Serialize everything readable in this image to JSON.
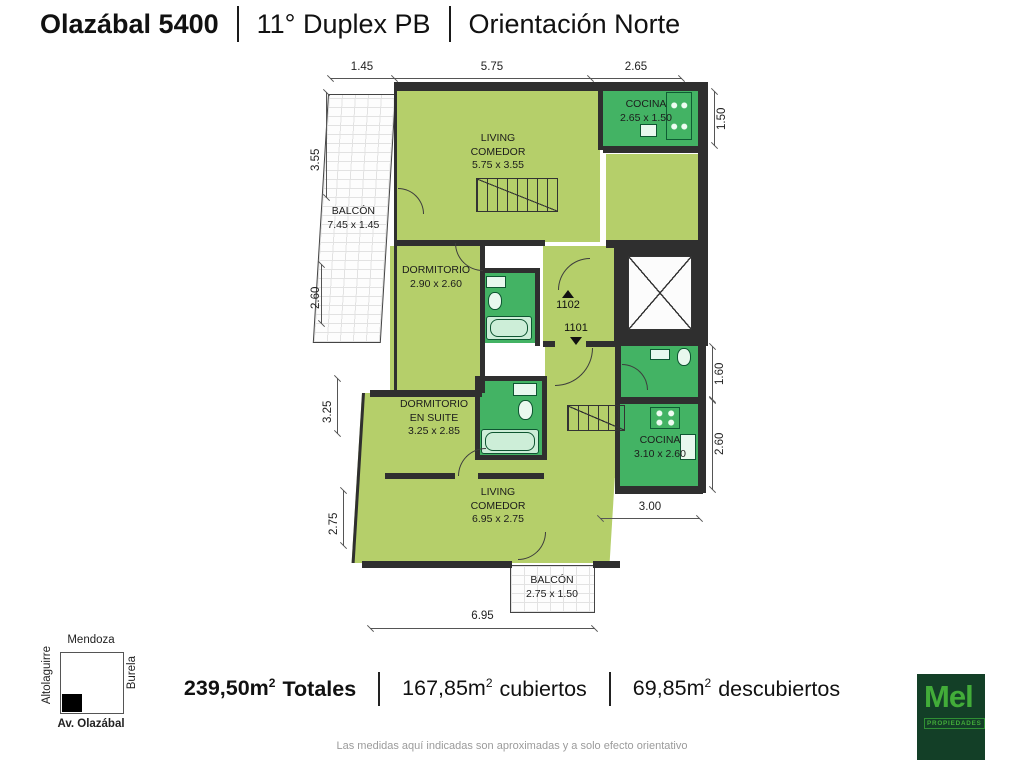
{
  "header": {
    "address": "Olazábal 5400",
    "unit": "11° Duplex PB",
    "orientation": "Orientación Norte"
  },
  "plan": {
    "rooms": {
      "living_top": {
        "name": "LIVING\nCOMEDOR",
        "size": "5.75 x 3.55"
      },
      "cocina_top": {
        "name": "COCINA",
        "size": "2.65 x 1.50"
      },
      "balcon_left": {
        "name": "BALCÓN",
        "size": "7.45 x 1.45"
      },
      "dormitorio": {
        "name": "DORMITORIO",
        "size": "2.90 x 2.60"
      },
      "suite": {
        "name": "DORMITORIO\nEN SUITE",
        "size": "3.25 x 2.85"
      },
      "cocina_bottom": {
        "name": "COCINA",
        "size": "3.10 x 2.60"
      },
      "living_bottom": {
        "name": "LIVING\nCOMEDOR",
        "size": "6.95 x 2.75"
      },
      "balcon_bottom": {
        "name": "BALCÓN",
        "size": "2.75 x 1.50"
      }
    },
    "doors": {
      "upper": "1102",
      "lower": "1101"
    },
    "dims": {
      "top": [
        "1.45",
        "5.75",
        "2.65"
      ],
      "left": [
        "3.55",
        "2.60",
        "3.25",
        "2.75"
      ],
      "right": [
        "1.50",
        "1.60",
        "2.60"
      ],
      "bottom_right": "3.00",
      "bottom": "6.95"
    }
  },
  "summary": {
    "separator": "|",
    "total": {
      "value": "239,50m",
      "sup": "2",
      "label": "Totales"
    },
    "covered": {
      "value": "167,85m",
      "sup": "2",
      "label": "cubiertos"
    },
    "uncovered": {
      "value": "69,85m",
      "sup": "2",
      "label": "descubiertos"
    }
  },
  "map": {
    "north": "Mendoza",
    "east": "Burela",
    "west": "Altolaguirre",
    "south": "Av. Olazábal"
  },
  "logo": {
    "brand": "Mel",
    "tagline": "PROPIEDADES"
  },
  "disclaimer": "Las medidas aquí indicadas son aproximadas y a solo efecto orientativo",
  "colors": {
    "room_light": "#b5cf6a",
    "room_green": "#43b364",
    "wall": "#2f2f2f",
    "logo_bg": "#133f27",
    "logo_green": "#42ac39"
  }
}
